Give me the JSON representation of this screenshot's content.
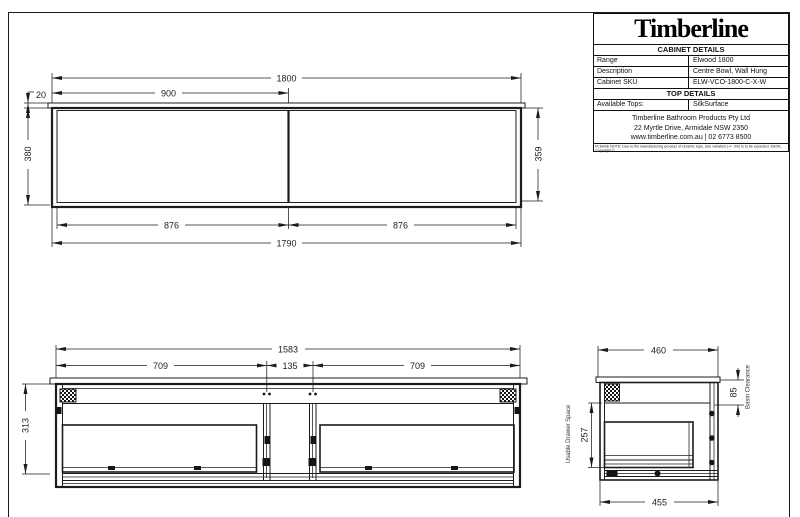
{
  "title_block": {
    "logo_text": "Timberline",
    "cabinet_details_header": "CABINET DETAILS",
    "rows": [
      {
        "label": "Range",
        "value": "Elwood 1800"
      },
      {
        "label": "Description",
        "value": "Centre Bowl, Wall Hung"
      },
      {
        "label": "Cabinet SKU",
        "value": "ELW-VCO-1800-C-X-W"
      }
    ],
    "top_details_header": "TOP DETAILS",
    "available_tops_label": "Available Tops:",
    "available_tops_value": "SilkSurface",
    "address_lines": [
      "Timberline Bathroom Products Pty Ltd",
      "22 Myrtle Drive, Armidale NSW 2350",
      "www.timberline.com.au  |  02 6773 8500"
    ],
    "note": "PLEASE NOTE: Due to the manufacturing process of ceramic tops, size variation (+/- 3%) is to be expected. E&OE. Copyright ©"
  },
  "plan_view": {
    "dim_overall_top": "1800",
    "dim_centre": "900",
    "dim_top_thickness": "20",
    "dim_depth": "380",
    "dim_inner_depth": "359",
    "dim_inner_width_left": "876",
    "dim_inner_width_right": "876",
    "dim_overall_bottom": "1790"
  },
  "front_view": {
    "dim_internal_width": "1583",
    "dim_drawer_left": "709",
    "dim_centre_gap": "135",
    "dim_drawer_right": "709",
    "dim_height": "313"
  },
  "side_view": {
    "dim_depth_top": "460",
    "dim_depth_bottom": "455",
    "dim_usable_drawer": "257",
    "dim_basin_clearance": "85",
    "label_usable_drawer": "Usable Drawer Space",
    "label_basin_clearance": "Basin Clearance"
  },
  "colors": {
    "ink": "#1c1c1c",
    "background": "#ffffff"
  }
}
